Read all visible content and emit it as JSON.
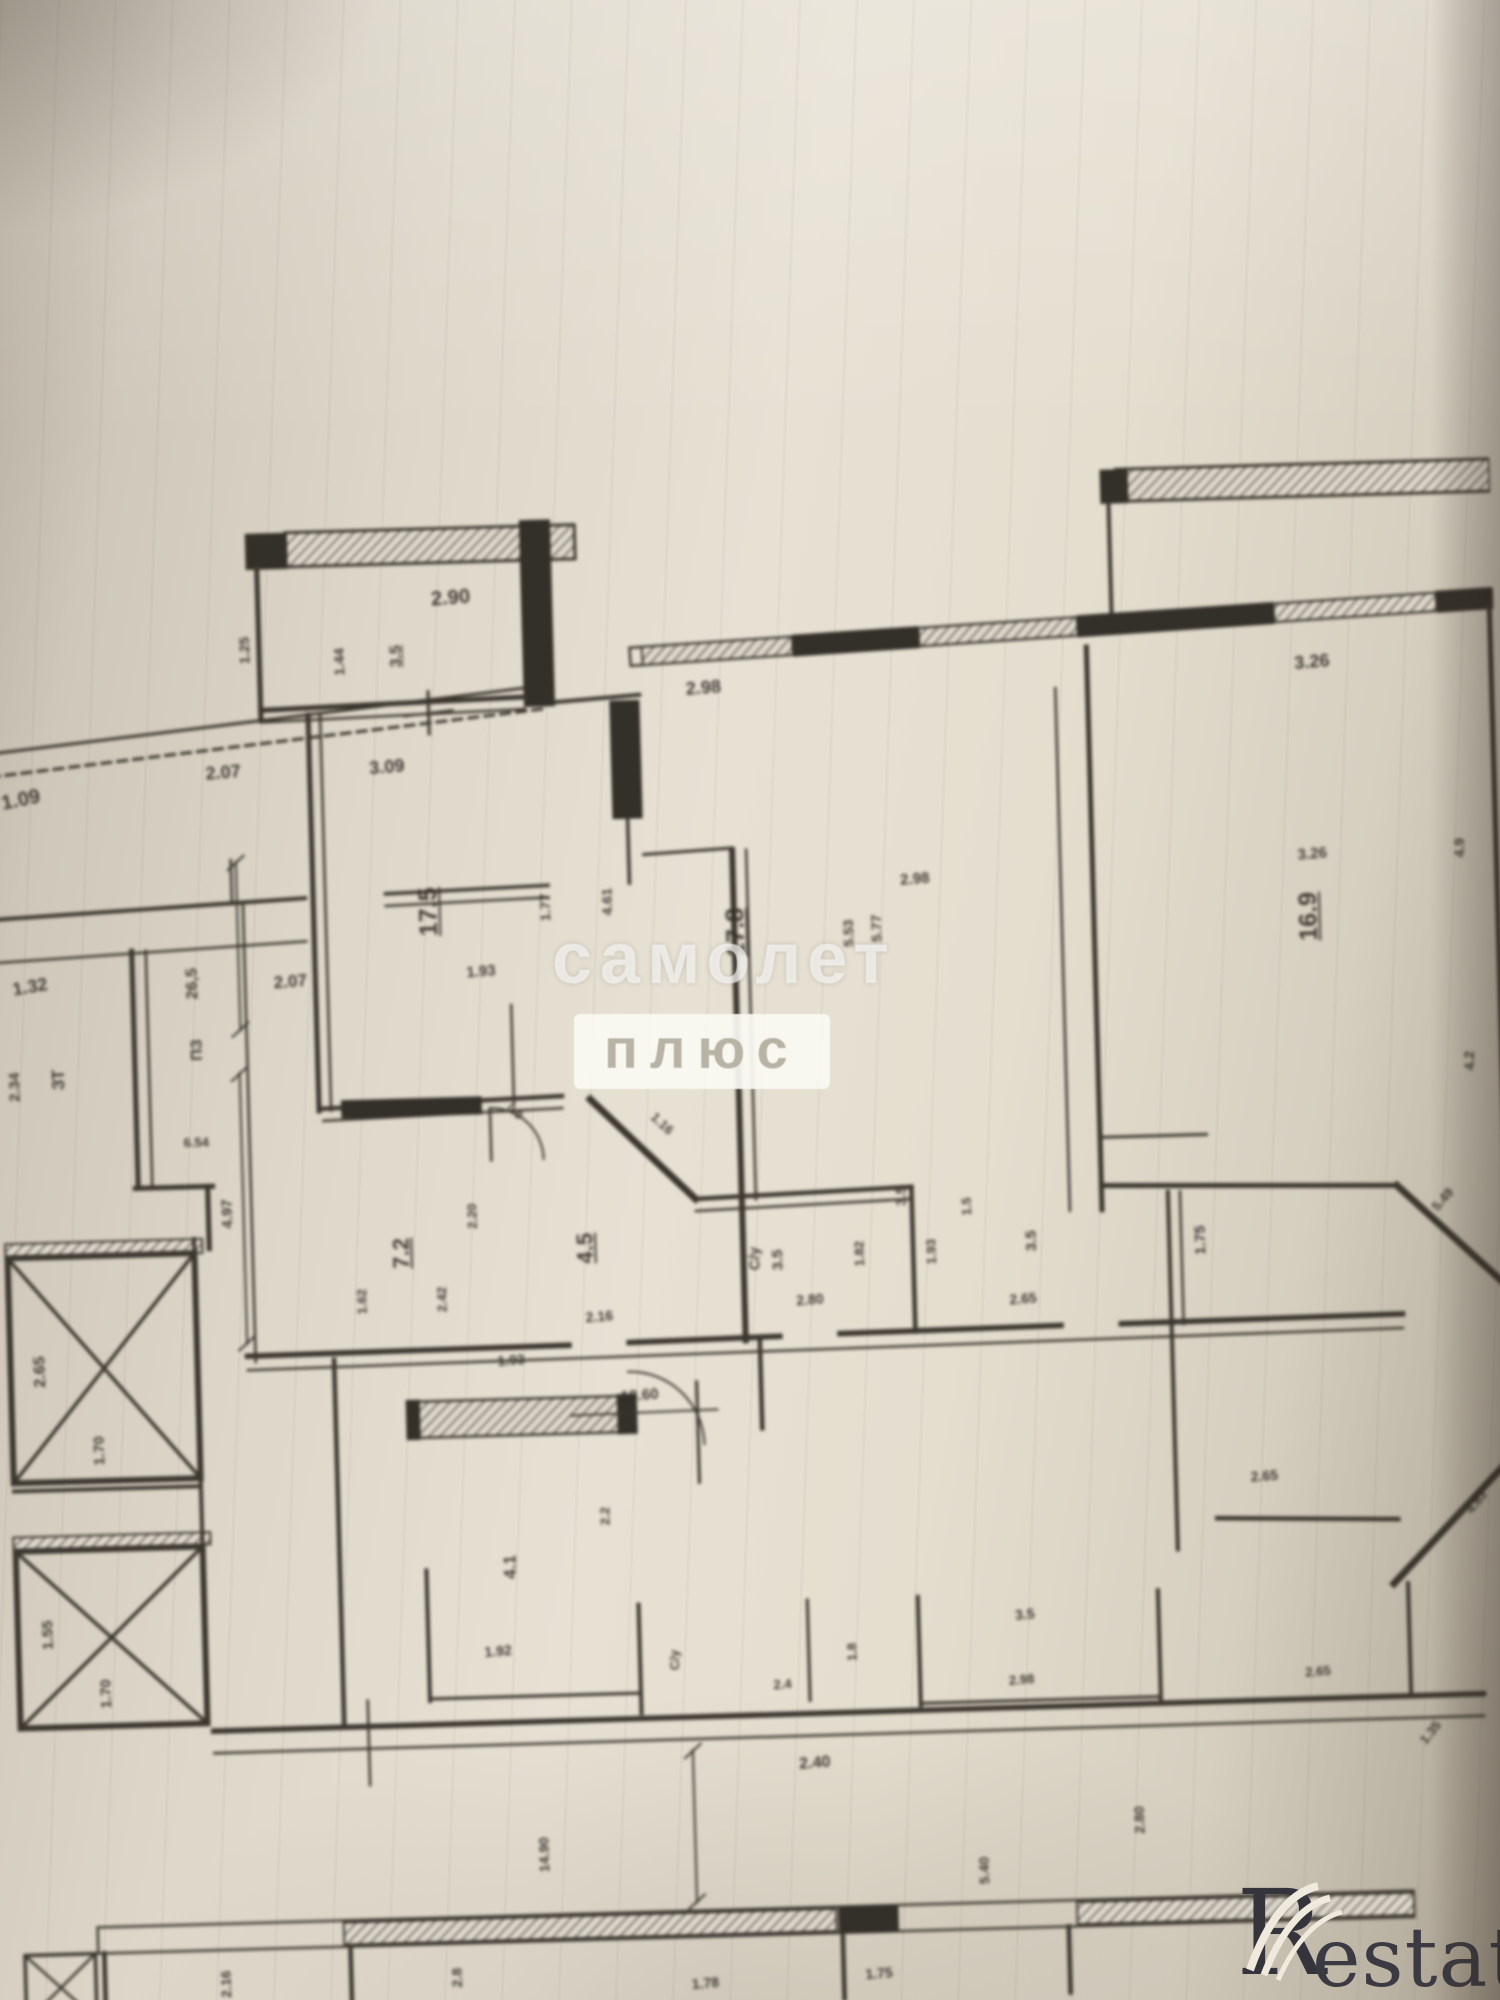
{
  "watermark": {
    "title": "самолет",
    "subtitle": "плюс"
  },
  "logo": {
    "letter": "R",
    "rest": "estate",
    "color": "#35343d"
  },
  "plan": {
    "ink_color": "#37322a",
    "paper_color": "#e7e1d4",
    "features": [
      "elevator-shaft-x2",
      "hatched-window-walls",
      "door-arcs",
      "dimension-lines"
    ]
  },
  "labels": [
    {
      "t": "1.09",
      "x": 30,
      "y": 783,
      "r": -10,
      "s": 20
    },
    {
      "t": "2.90",
      "x": 463,
      "y": 594,
      "r": -3,
      "s": 20
    },
    {
      "t": "3.5",
      "x": 408,
      "y": 650,
      "r": -90,
      "s": 16,
      "u": 1
    },
    {
      "t": "1.25",
      "x": 256,
      "y": 640,
      "r": -90,
      "s": 14
    },
    {
      "t": "1.44",
      "x": 350,
      "y": 654,
      "r": -90,
      "s": 14
    },
    {
      "t": "2.07",
      "x": 232,
      "y": 761,
      "r": -3,
      "s": 18
    },
    {
      "t": "3.09",
      "x": 395,
      "y": 760,
      "r": -3,
      "s": 18
    },
    {
      "t": "2.98",
      "x": 712,
      "y": 690,
      "r": -3,
      "s": 18
    },
    {
      "t": "3.26",
      "x": 1318,
      "y": 681,
      "r": -3,
      "s": 18
    },
    {
      "t": "1.32",
      "x": 34,
      "y": 969,
      "r": -8,
      "s": 18
    },
    {
      "t": "2.34",
      "x": 16,
      "y": 1068,
      "r": -90,
      "s": 15
    },
    {
      "t": "ЗТ",
      "x": 60,
      "y": 1062,
      "r": -90,
      "s": 17
    },
    {
      "t": "26,5",
      "x": 196,
      "y": 970,
      "r": -90,
      "s": 16
    },
    {
      "t": "ПЗ",
      "x": 199,
      "y": 1036,
      "r": -90,
      "s": 16
    },
    {
      "t": "2.07",
      "x": 293,
      "y": 971,
      "r": -3,
      "s": 17
    },
    {
      "t": "6.54",
      "x": 195,
      "y": 1128,
      "r": 0,
      "s": 13
    },
    {
      "t": "4.97",
      "x": 224,
      "y": 1200,
      "r": -90,
      "s": 15
    },
    {
      "t": "2.65",
      "x": 34,
      "y": 1352,
      "r": -90,
      "s": 16
    },
    {
      "t": "1.70",
      "x": 90,
      "y": 1432,
      "r": -90,
      "s": 15
    },
    {
      "t": "1.55",
      "x": 34,
      "y": 1614,
      "r": -90,
      "s": 15
    },
    {
      "t": "1.70",
      "x": 90,
      "y": 1674,
      "r": -90,
      "s": 15
    },
    {
      "t": "17.5",
      "x": 433,
      "y": 905,
      "r": -90,
      "s": 25,
      "u": 1
    },
    {
      "t": "1.77",
      "x": 548,
      "y": 904,
      "r": -90,
      "s": 14
    },
    {
      "t": "4.61",
      "x": 610,
      "y": 900,
      "r": -90,
      "s": 14
    },
    {
      "t": "1.93",
      "x": 483,
      "y": 966,
      "r": -3,
      "s": 15
    },
    {
      "t": "17.8",
      "x": 738,
      "y": 934,
      "r": -90,
      "s": 25,
      "u": 1
    },
    {
      "t": "5.53",
      "x": 849,
      "y": 938,
      "r": -90,
      "s": 14
    },
    {
      "t": "5.77",
      "x": 877,
      "y": 934,
      "r": -90,
      "s": 14
    },
    {
      "t": "2.98",
      "x": 917,
      "y": 886,
      "r": -3,
      "s": 15
    },
    {
      "t": "16.9",
      "x": 1308,
      "y": 934,
      "r": -90,
      "s": 25,
      "u": 1
    },
    {
      "t": "3.26",
      "x": 1313,
      "y": 872,
      "r": -3,
      "s": 15
    },
    {
      "t": "4.9",
      "x": 1459,
      "y": 870,
      "r": -90,
      "s": 14
    },
    {
      "t": "4.2",
      "x": 1463,
      "y": 1082,
      "r": -90,
      "s": 14
    },
    {
      "t": "0.9",
      "x": 513,
      "y": 1106,
      "r": 45,
      "s": 12
    },
    {
      "t": "1.16",
      "x": 659,
      "y": 1122,
      "r": 45,
      "s": 13
    },
    {
      "t": "4.5",
      "x": 579,
      "y": 1244,
      "r": -90,
      "s": 22,
      "u": 1
    },
    {
      "t": "7.2",
      "x": 396,
      "y": 1244,
      "r": -90,
      "s": 22,
      "u": 1
    },
    {
      "t": "2.20",
      "x": 467,
      "y": 1209,
      "r": -90,
      "s": 13
    },
    {
      "t": "1.62",
      "x": 355,
      "y": 1291,
      "r": -90,
      "s": 13
    },
    {
      "t": "2.42",
      "x": 435,
      "y": 1291,
      "r": -90,
      "s": 13
    },
    {
      "t": "2.16",
      "x": 591,
      "y": 1312,
      "r": -3,
      "s": 14
    },
    {
      "t": "С/у",
      "x": 747,
      "y": 1259,
      "r": -90,
      "s": 15
    },
    {
      "t": "3.5",
      "x": 770,
      "y": 1261,
      "r": -90,
      "s": 15
    },
    {
      "t": "2.80",
      "x": 801,
      "y": 1301,
      "r": -3,
      "s": 14
    },
    {
      "t": "1.82",
      "x": 851,
      "y": 1257,
      "r": -90,
      "s": 13
    },
    {
      "t": "1.93",
      "x": 923,
      "y": 1257,
      "r": -90,
      "s": 13
    },
    {
      "t": "3.5",
      "x": 1023,
      "y": 1249,
      "r": -90,
      "s": 15
    },
    {
      "t": "2.65",
      "x": 1013,
      "y": 1306,
      "r": -3,
      "s": 14
    },
    {
      "t": "1.75",
      "x": 1191,
      "y": 1253,
      "r": -90,
      "s": 15
    },
    {
      "t": "5.49",
      "x": 1433,
      "y": 1219,
      "r": -47,
      "s": 13
    },
    {
      "t": "3.5",
      "x": 894,
      "y": 1201,
      "r": -90,
      "s": 14
    },
    {
      "t": "1.5",
      "x": 959,
      "y": 1213,
      "r": -90,
      "s": 13
    },
    {
      "t": "1.93",
      "x": 502,
      "y": 1353,
      "r": -3,
      "s": 14
    },
    {
      "t": "4.1",
      "x": 496,
      "y": 1559,
      "r": -90,
      "s": 17
    },
    {
      "t": "2.2",
      "x": 591,
      "y": 1511,
      "r": -90,
      "s": 13
    },
    {
      "t": "18.60",
      "x": 629,
      "y": 1392,
      "r": -3,
      "s": 15
    },
    {
      "t": "2.65",
      "x": 1248,
      "y": 1489,
      "r": -3,
      "s": 14
    },
    {
      "t": "4.83",
      "x": 1458,
      "y": 1521,
      "r": -50,
      "s": 13
    },
    {
      "t": "2.40",
      "x": 793,
      "y": 1763,
      "r": -3,
      "s": 16
    },
    {
      "t": "14.90",
      "x": 521,
      "y": 1846,
      "r": -90,
      "s": 14
    },
    {
      "t": "2.80",
      "x": 1114,
      "y": 1828,
      "r": -90,
      "s": 14
    },
    {
      "t": "5.40",
      "x": 958,
      "y": 1874,
      "r": -90,
      "s": 14
    },
    {
      "t": "1.35",
      "x": 1406,
      "y": 1749,
      "r": -50,
      "s": 13
    },
    {
      "t": "1.92",
      "x": 481,
      "y": 1642,
      "r": -3,
      "s": 14
    },
    {
      "t": "С/у",
      "x": 656,
      "y": 1656,
      "r": -90,
      "s": 13
    },
    {
      "t": "2.4",
      "x": 763,
      "y": 1683,
      "r": -3,
      "s": 13
    },
    {
      "t": "1.8",
      "x": 833,
      "y": 1653,
      "r": -90,
      "s": 13
    },
    {
      "t": "3.5",
      "x": 1006,
      "y": 1620,
      "r": -3,
      "s": 14
    },
    {
      "t": "2.98",
      "x": 1001,
      "y": 1685,
      "r": -3,
      "s": 13
    },
    {
      "t": "2.65",
      "x": 1296,
      "y": 1685,
      "r": -3,
      "s": 13
    },
    {
      "t": "2.8",
      "x": 431,
      "y": 1966,
      "r": -90,
      "s": 14
    },
    {
      "t": "1.78",
      "x": 678,
      "y": 1978,
      "r": -3,
      "s": 14
    },
    {
      "t": "1.75",
      "x": 851,
      "y": 1973,
      "r": -3,
      "s": 14
    },
    {
      "t": "2.16",
      "x": 201,
      "y": 1966,
      "r": -90,
      "s": 14
    }
  ]
}
